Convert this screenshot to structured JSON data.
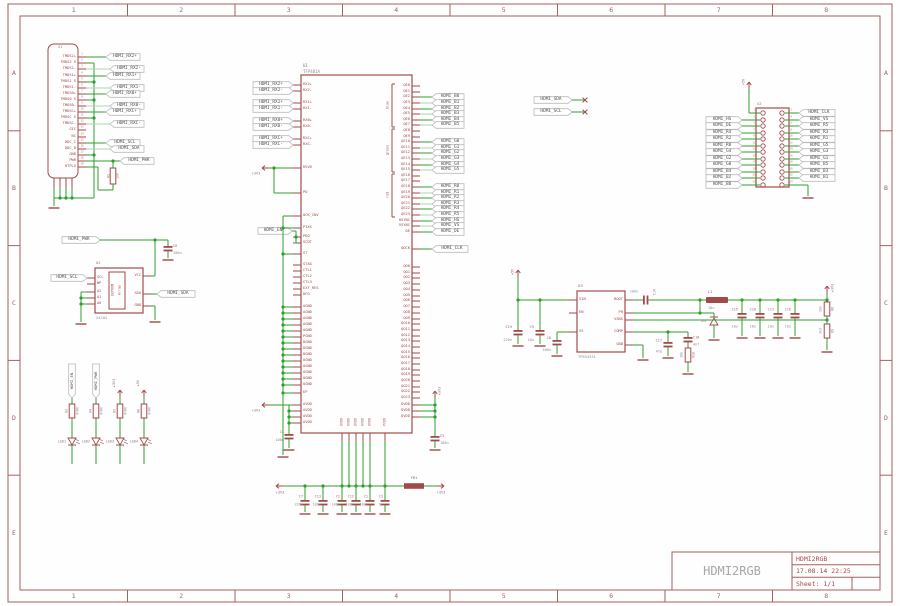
{
  "colors": {
    "wire": "#2d9e2d",
    "wire_pale": "#a9d5a9",
    "part": "#a14a4a",
    "name_text": "#9a6a6a",
    "value_text": "#8d8d8d",
    "flag_text": "#525252",
    "flag_stroke": "#bbbbbb",
    "frame": "#a56060",
    "logo": "#a6a6a6",
    "tb_text": "#a14a4a",
    "pin_number": "#b07878"
  },
  "frame": {
    "columns": [
      "1",
      "2",
      "3",
      "4",
      "5",
      "6",
      "7",
      "8"
    ],
    "rows": [
      "A",
      "B",
      "C",
      "D",
      "E"
    ]
  },
  "title_block": {
    "logo": "HDMI2RGB",
    "project": "HDMI2RGB",
    "date": "17.08.14 22:25",
    "sheet": "Sheet: 1/1"
  },
  "power": {
    "v5": "+5V",
    "v33": "+3V3"
  },
  "x1": {
    "designator": "X1",
    "pins": [
      "TMDS2+",
      "TMDS2 S",
      "TMDS2-",
      "TMDS1+",
      "TMDS1 S",
      "TMDS1-",
      "TMDS0+",
      "TMDS0 S",
      "TMDS0-",
      "TMDSC+",
      "TMDSC S",
      "TMDSC-",
      "CEC",
      "NC",
      "DDC_C",
      "DDC_D",
      "GND",
      "PWR",
      "HTPLG"
    ],
    "pin_numbers": [
      "1",
      "2",
      "3",
      "4",
      "5",
      "6",
      "7",
      "8",
      "9",
      "10",
      "11",
      "12",
      "13",
      "14",
      "15",
      "16",
      "17",
      "18",
      "19"
    ],
    "flags": {
      "rx2p": "HDMI_RX2+",
      "rx2n": "HDMI_RX2-",
      "rx1p": "HDMI_RX1+",
      "rx1n": "HDMI_RX1-",
      "rx0p": "HDMI_RX0+",
      "rx0n": "HDMI_RX0-",
      "rxcp": "HDMI_RXC+",
      "rxcn": "HDMI_RXC-",
      "scl": "HDMI_SCL",
      "sda": "HDMI_SDA",
      "pwr": "HDMI_PWR"
    },
    "r1": {
      "name": "R1",
      "value": "10k"
    }
  },
  "u1": {
    "designator": "U1",
    "part": "TFP401A",
    "left_pins": [
      "RX2+",
      "RX2-",
      "RX1+",
      "RX1-",
      "RX0+",
      "RX0-",
      "RXC+",
      "RXC-",
      "RSVD",
      "PD",
      "OCK_INV",
      "PIXS",
      "PDO",
      "SCDT",
      "ST",
      "STAG",
      "CTL1",
      "CTL2",
      "CTL3",
      "EXT_RES",
      "DFO",
      "AGND",
      "AGND",
      "AGND",
      "AGND",
      "AGND",
      "PGND",
      "DGND",
      "DGND",
      "DGND",
      "OGND",
      "OGND",
      "OGND",
      "OGND",
      "OGND",
      "EP",
      "AVDD",
      "AVDD",
      "AVDD",
      "AVDD"
    ],
    "qe_pins": [
      "QE0",
      "QE1",
      "QE2",
      "QE3",
      "QE4",
      "QE5",
      "QE6",
      "QE7",
      "QE8",
      "QE9",
      "QE10",
      "QE11",
      "QE12",
      "QE13",
      "QE14",
      "QE15",
      "QE16",
      "QE17",
      "QE18",
      "QE19",
      "QE20",
      "QE21",
      "QE22",
      "QE23"
    ],
    "sync_pins": [
      "HSYNC",
      "VSYNC",
      "DE"
    ],
    "clk_pin": "ODCK",
    "qo_pins": [
      "QO0",
      "QO1",
      "QO2",
      "QO3",
      "QO4",
      "QO5",
      "QO6",
      "QO7",
      "QO8",
      "QO9",
      "QO10",
      "QO11",
      "QO12",
      "QO13",
      "QO14",
      "QO15",
      "QO16",
      "QO17",
      "QO18",
      "QO19",
      "QO20",
      "QO21",
      "QO22",
      "QO23"
    ],
    "dvdd": "DVDD",
    "ovdd": "OVDD",
    "pvdd": "PVDD",
    "groups": [
      "blue",
      "green",
      "red"
    ],
    "rx_flags": [
      "HDMI_RX2+",
      "HDMI_RX2-",
      "HDMI_RX1+",
      "HDMI_RX1-",
      "HDMI_RX0+",
      "HDMI_RX0-",
      "HDMI_RXC+",
      "HDMI_RXC-"
    ],
    "b_flags": [
      "HDMI_B0",
      "HDMI_B1",
      "HDMI_B2",
      "HDMI_B3",
      "HDMI_B4",
      "HDMI_B5"
    ],
    "g_flags": [
      "HDMI_G0",
      "HDMI_G1",
      "HDMI_G2",
      "HDMI_G3",
      "HDMI_G4",
      "HDMI_G5"
    ],
    "r_flags": [
      "HDMI_R0",
      "HDMI_R1",
      "HDMI_R2",
      "HDMI_R3",
      "HDMI_R4",
      "HDMI_R5"
    ],
    "hs_flag": "HDMI_HS",
    "vs_flag": "HDMI_VS",
    "de_flag": "HDMI_DE",
    "clk_flag": "HDMI_CLK",
    "en_flag": "HDMI_EN",
    "c4": {
      "name": "C4",
      "value": "100n"
    },
    "c5": {
      "name": "C5",
      "value": "100n"
    }
  },
  "eeprom": {
    "designator": "U2",
    "part": "24C02",
    "core": [
      "EEPROM",
      "Array"
    ],
    "left_pins": [
      "SCL",
      "WP",
      "A2",
      "A1",
      "A0"
    ],
    "right_pins": [
      "VCC",
      "SDA",
      "GND"
    ],
    "flags": {
      "scl": "HDMI_SCL",
      "sda": "HDMI_SDA",
      "pwr": "HDMI_PWR"
    },
    "c6": {
      "name": "C6",
      "value": "100n"
    }
  },
  "i2c": {
    "sda": "HDMI_SDA",
    "scl": "HDMI_SCL"
  },
  "leds": {
    "items": [
      {
        "net": "HDMI_EN",
        "resistor": "R3",
        "value": "470R",
        "led": "LED1"
      },
      {
        "net": "HDMI_PWR",
        "resistor": "R4",
        "value": "470R",
        "led": "LED2"
      },
      {
        "net": "+3V3",
        "resistor": "R5",
        "value": "470R",
        "led": "LED3"
      },
      {
        "net": "+5V",
        "resistor": "R6",
        "value": "470R",
        "led": "LED4"
      }
    ]
  },
  "header": {
    "designator": "X2",
    "left_flags": [
      "HDMI_HS",
      "HDMI_DE",
      "HDMI_R4",
      "HDMI_R2",
      "HDMI_R0",
      "HDMI_G4",
      "HDMI_G2",
      "HDMI_G0",
      "HDMI_B4",
      "HDMI_B2",
      "HDMI_B0"
    ],
    "right_flags": [
      "HDMI_CLK",
      "HDMI_VS",
      "HDMI_R5",
      "HDMI_R3",
      "HDMI_R1",
      "HDMI_G5",
      "HDMI_G3",
      "HDMI_G1",
      "HDMI_B5",
      "HDMI_B3",
      "HDMI_B1"
    ],
    "left_pin_numbers": [
      "1",
      "3",
      "5",
      "7",
      "9",
      "11",
      "13",
      "15",
      "17",
      "19",
      "21",
      "23"
    ],
    "right_pin_numbers": [
      "2",
      "4",
      "6",
      "8",
      "10",
      "12",
      "14",
      "16",
      "18",
      "20",
      "22",
      "24"
    ]
  },
  "regulator": {
    "designator": "U3",
    "part": "TPS54331",
    "left_pins": [
      "VIN",
      "EN",
      "SS"
    ],
    "right_pins": [
      "BOOT",
      "PH",
      "VSNS",
      "COMP",
      "GND"
    ],
    "parts": {
      "c19": {
        "name": "C19",
        "value": "220n"
      },
      "c9": {
        "name": "C9",
        "value": "10u"
      },
      "c8": {
        "name": "C8",
        "value": "100n"
      },
      "c14": {
        "name": "C14",
        "value": "100n"
      },
      "l1": {
        "name": "L1",
        "value": "10u"
      },
      "d1": {
        "name": "D1"
      },
      "c15": {
        "name": "C15",
        "value": "10u"
      },
      "c10": {
        "name": "C10",
        "value": "10u"
      },
      "c11": {
        "name": "C11",
        "value": "10u"
      },
      "c16": {
        "name": "C16",
        "value": "10u"
      },
      "r8": {
        "name": "R8",
        "value": "10k"
      },
      "r9": {
        "name": "R9",
        "value": "3k3"
      },
      "c17": {
        "name": "C17",
        "value": "47p"
      },
      "c18": {
        "name": "C18",
        "value": "4n7"
      },
      "r10": {
        "name": "R10",
        "value": "10k"
      }
    }
  },
  "decoupling": {
    "caps": [
      {
        "name": "C7",
        "value": "220n"
      },
      {
        "name": "C13",
        "value": "100n"
      },
      {
        "name": "C2",
        "value": "100n"
      },
      {
        "name": "C12",
        "value": "100n"
      },
      {
        "name": "C1",
        "value": "100n"
      },
      {
        "name": "C3",
        "value": "1n"
      }
    ],
    "fb1": "FB1"
  }
}
